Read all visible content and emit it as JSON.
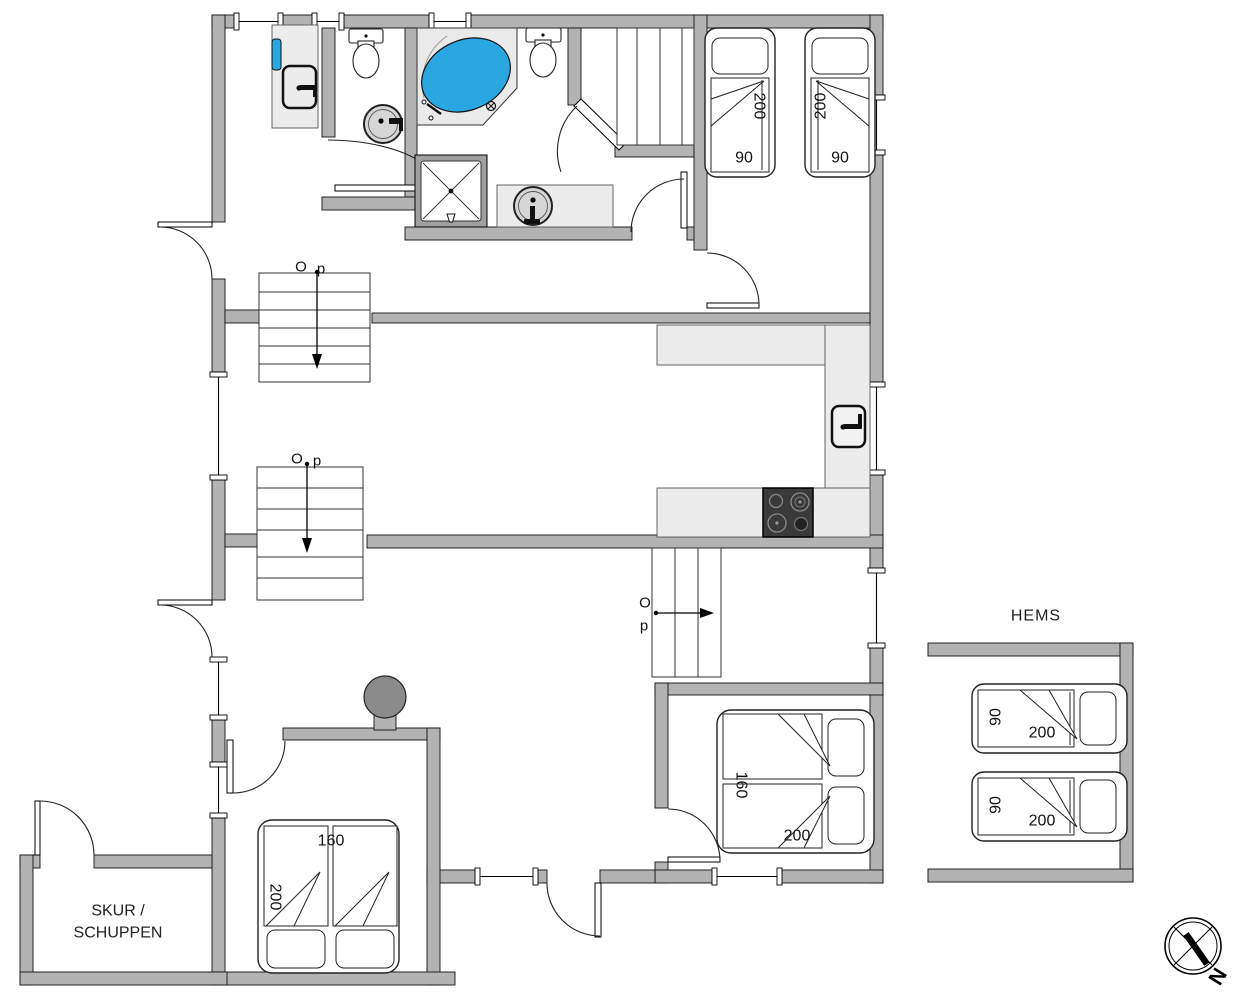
{
  "colors": {
    "wall": "#b3b3b3",
    "counter": "#ececec",
    "tub_water": "#2aa7e0",
    "stove_top": "#3a3a3a",
    "fireplace": "#8a8a8a"
  },
  "labels": {
    "hems": "HEMS",
    "shed_line1": "SKUR /",
    "shed_line2": "SCHUPPEN"
  },
  "compass": {
    "north": "N"
  },
  "stairs": {
    "s1": {
      "o": "O",
      "p": "p"
    },
    "s2": {
      "o": "O",
      "p": "p"
    },
    "s3": {
      "o": "O",
      "p": "p"
    }
  },
  "beds": {
    "top_bed_1": {
      "length": "200",
      "width": "90"
    },
    "top_bed_2": {
      "length": "200",
      "width": "90"
    },
    "mid_double": {
      "width": "160",
      "length": "200"
    },
    "left_double": {
      "width": "160",
      "length": "200"
    },
    "hems_bed_1": {
      "width": "90",
      "length": "200"
    },
    "hems_bed_2": {
      "width": "90",
      "length": "200"
    }
  }
}
